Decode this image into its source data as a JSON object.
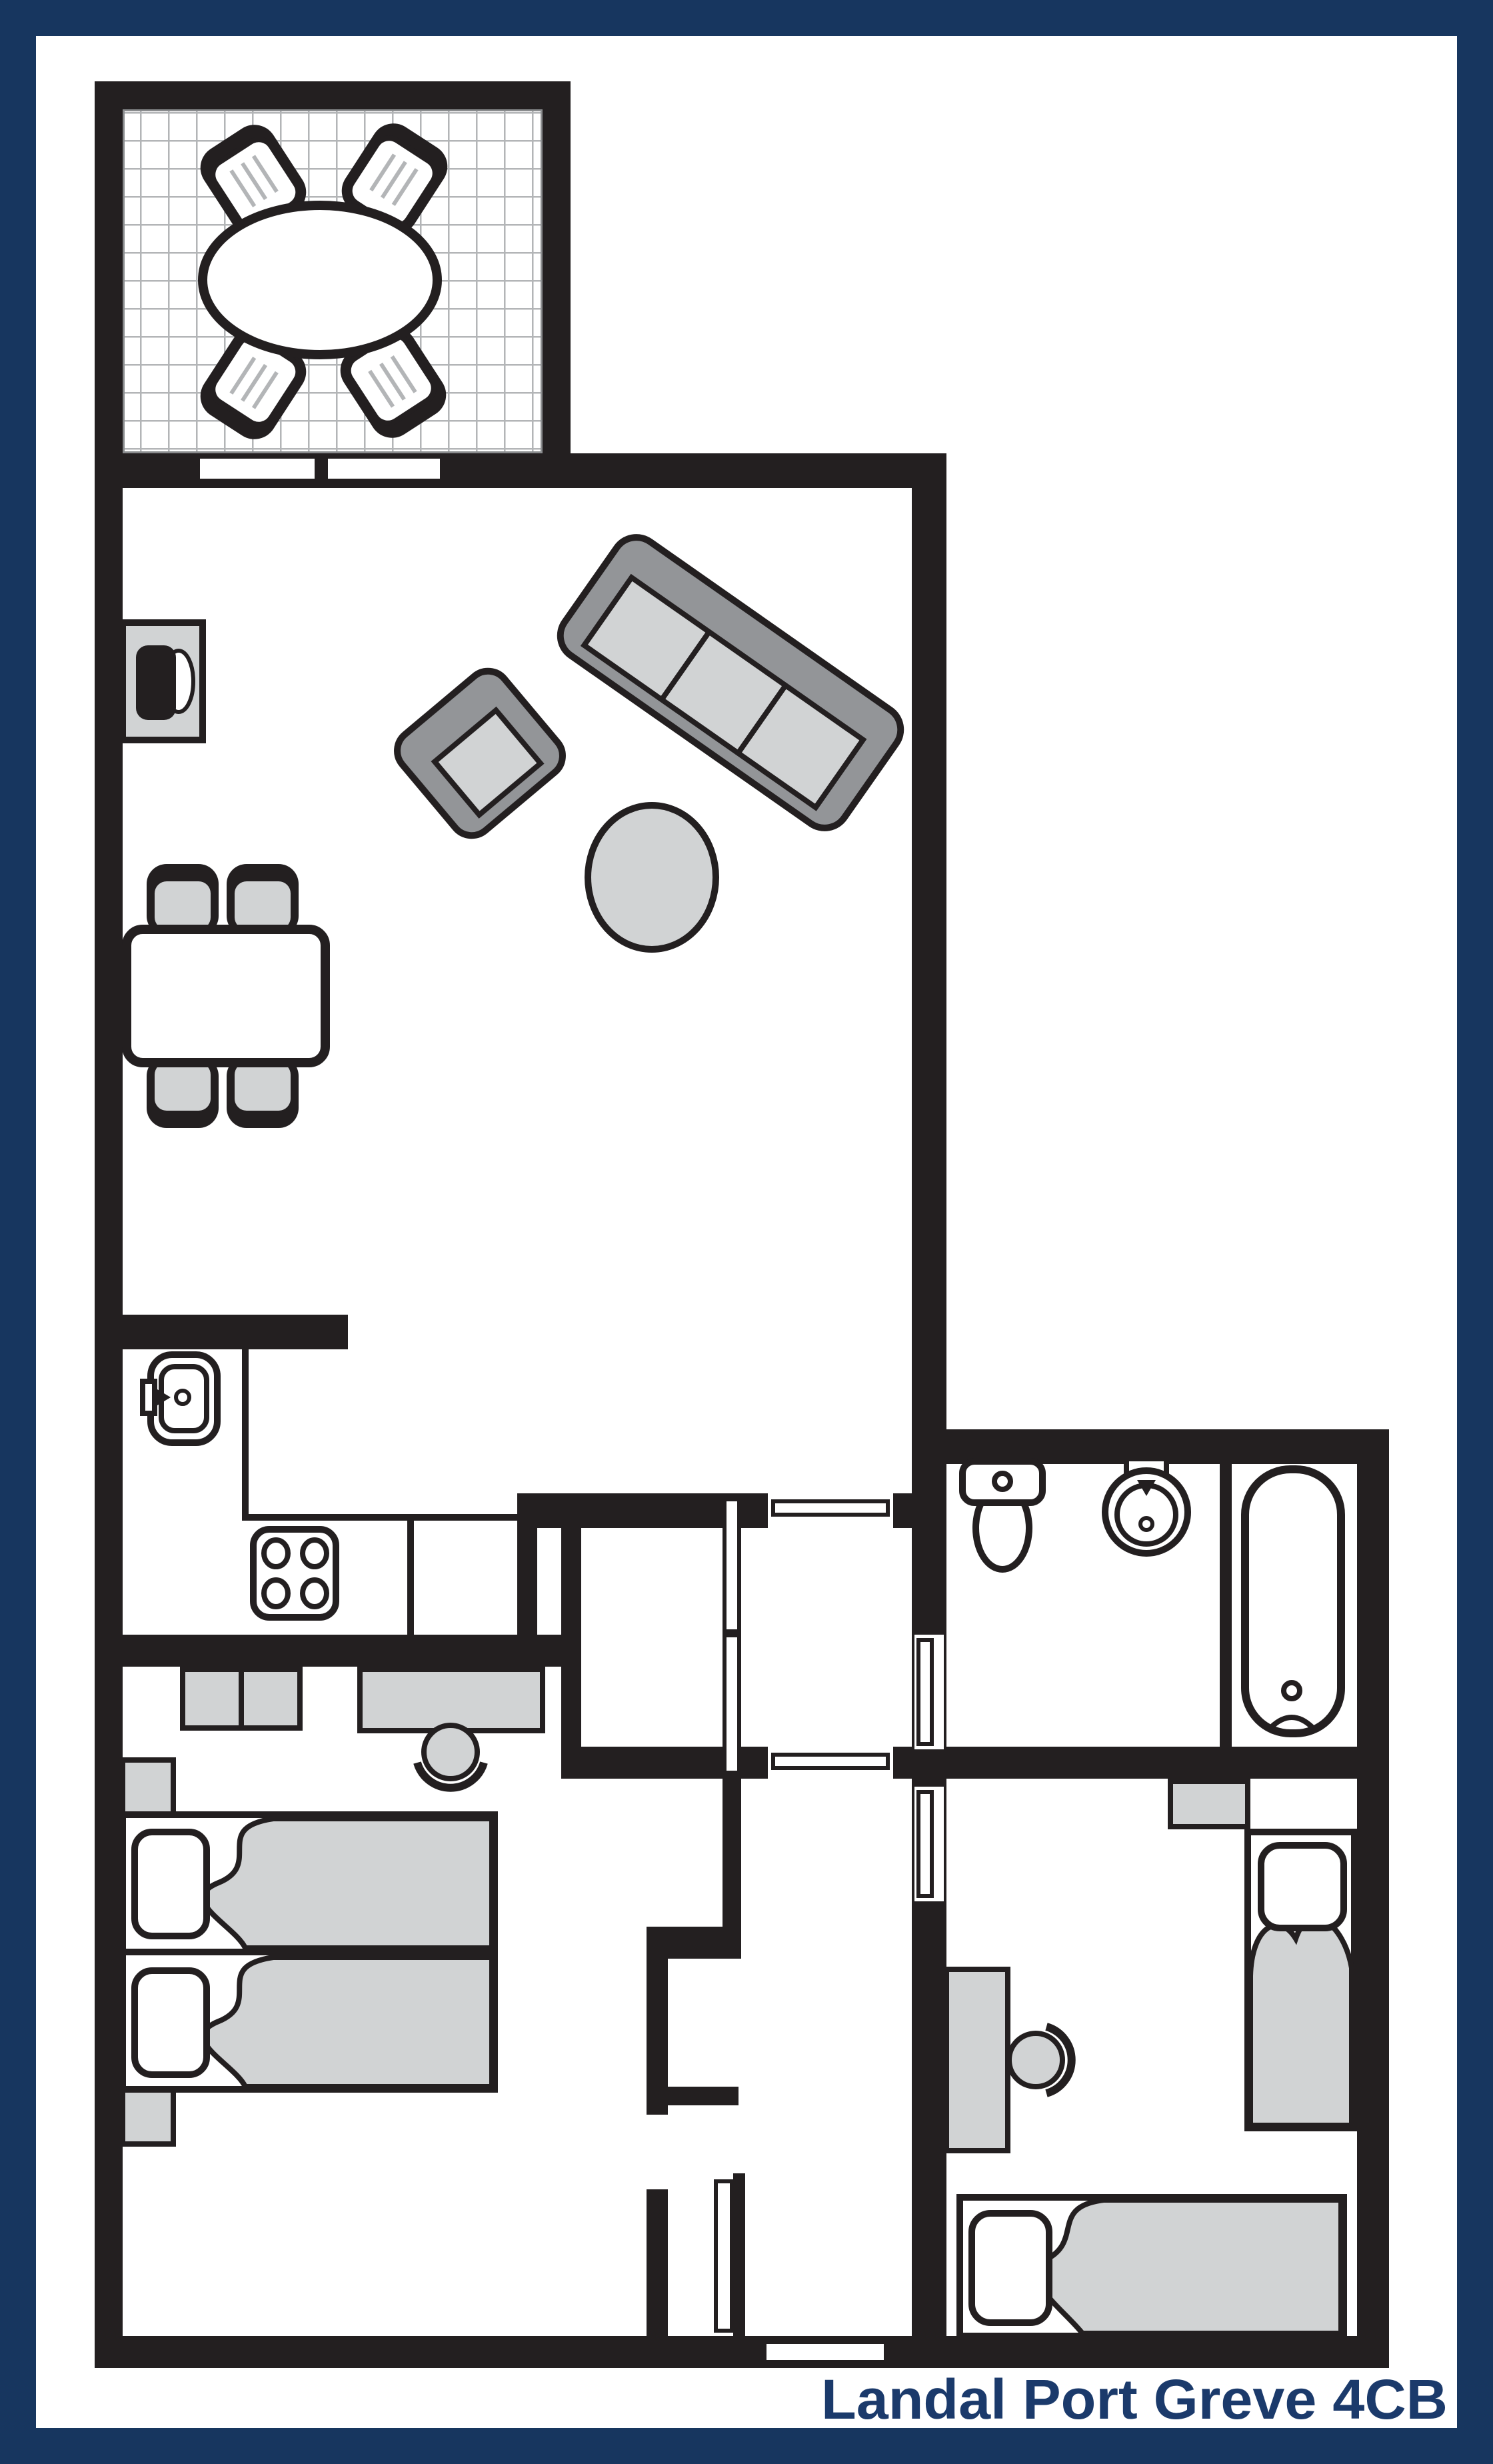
{
  "title": {
    "label": "Landal Port Greve 4CB"
  },
  "colors": {
    "border_navy": "#17365f",
    "text_navy": "#1b3a6b",
    "wall_black": "#231f20",
    "furniture_light": "#d1d3d4",
    "furniture_mid": "#939598",
    "tile_line": "#b3b5b7",
    "background": "#ffffff"
  },
  "floor_plan": {
    "type": "holiday-home floor plan, top-down view",
    "unit_label": "Landal Port Greve 4CB",
    "rooms": [
      {
        "name": "terrace",
        "position": "top-left",
        "features": [
          "tiled floor grid",
          "oval dining table",
          "4 patio chairs"
        ]
      },
      {
        "name": "living-room",
        "position": "upper-middle",
        "features": [
          "3-seat sofa (angled)",
          "armchair (angled)",
          "round coffee table",
          "tv-cabinet on left wall",
          "dining table with 4 chairs",
          "2 windows to terrace"
        ]
      },
      {
        "name": "kitchen",
        "position": "middle-left",
        "features": [
          "sink with faucet",
          "4-burner hob",
          "L-shaped counter"
        ]
      },
      {
        "name": "hallway",
        "position": "center",
        "features": [
          "closet with double doors",
          "door to living room",
          "door to corridor"
        ]
      },
      {
        "name": "bathroom",
        "position": "middle-right",
        "features": [
          "toilet",
          "round washbasin",
          "bathtub with drain and tap"
        ]
      },
      {
        "name": "bedroom-1",
        "position": "bottom-left",
        "features": [
          "double bed (two mattresses)",
          "2 pillows",
          "2 nightstands",
          "wardrobe units",
          "desk",
          "desk chair"
        ]
      },
      {
        "name": "bedroom-2",
        "position": "bottom-right",
        "features": [
          "single bed along right wall",
          "single bed along bottom wall",
          "2 pillows",
          "desk",
          "desk chair",
          "small cabinet"
        ]
      },
      {
        "name": "corridor",
        "position": "bottom-center",
        "features": [
          "front door at bottom wall",
          "door to bedroom-1",
          "door to bedroom-2",
          "door to bathroom"
        ]
      }
    ],
    "door_count": 7,
    "window_count": 2
  }
}
